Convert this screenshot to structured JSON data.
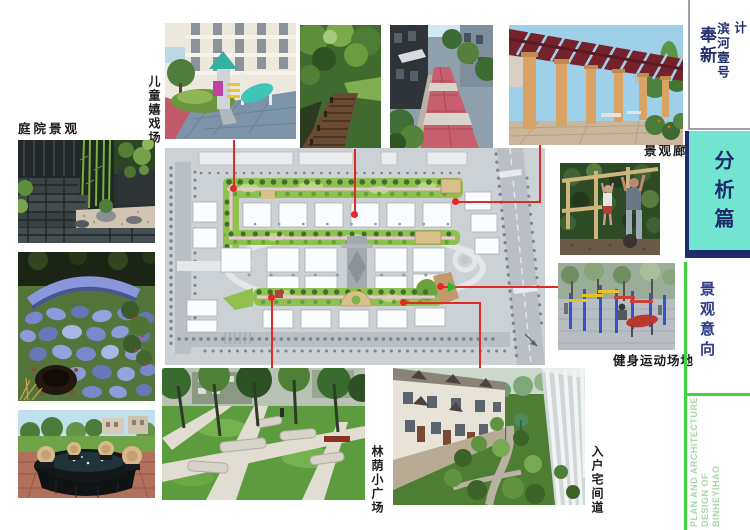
{
  "header": {
    "project_name": "奉新",
    "project_number": "滨河壹号",
    "doc_type": "规划建筑方案设计"
  },
  "section": {
    "chapter": "分析篇",
    "page_title": "景观意向"
  },
  "footer": {
    "en_line1": "PLAN AND ARCHITECTURE",
    "en_line2": "DESIGN OF",
    "en_line3": "BINHEYIHAO"
  },
  "photo_labels": {
    "children_playground": "儿童嬉戏场",
    "courtyard": "庭院景观",
    "corridor": "景观廊",
    "fitness": "健身运动场地",
    "plaza": "林荫小广场",
    "lane": "入户宅间道"
  },
  "colors": {
    "accent_cyan": "#72e5d0",
    "navy": "#1f2b6d",
    "connector_red": "#e02a26",
    "accent_green": "#3fd53f",
    "footer_green": "#a6d8a6",
    "plan_green": "#90c050"
  }
}
